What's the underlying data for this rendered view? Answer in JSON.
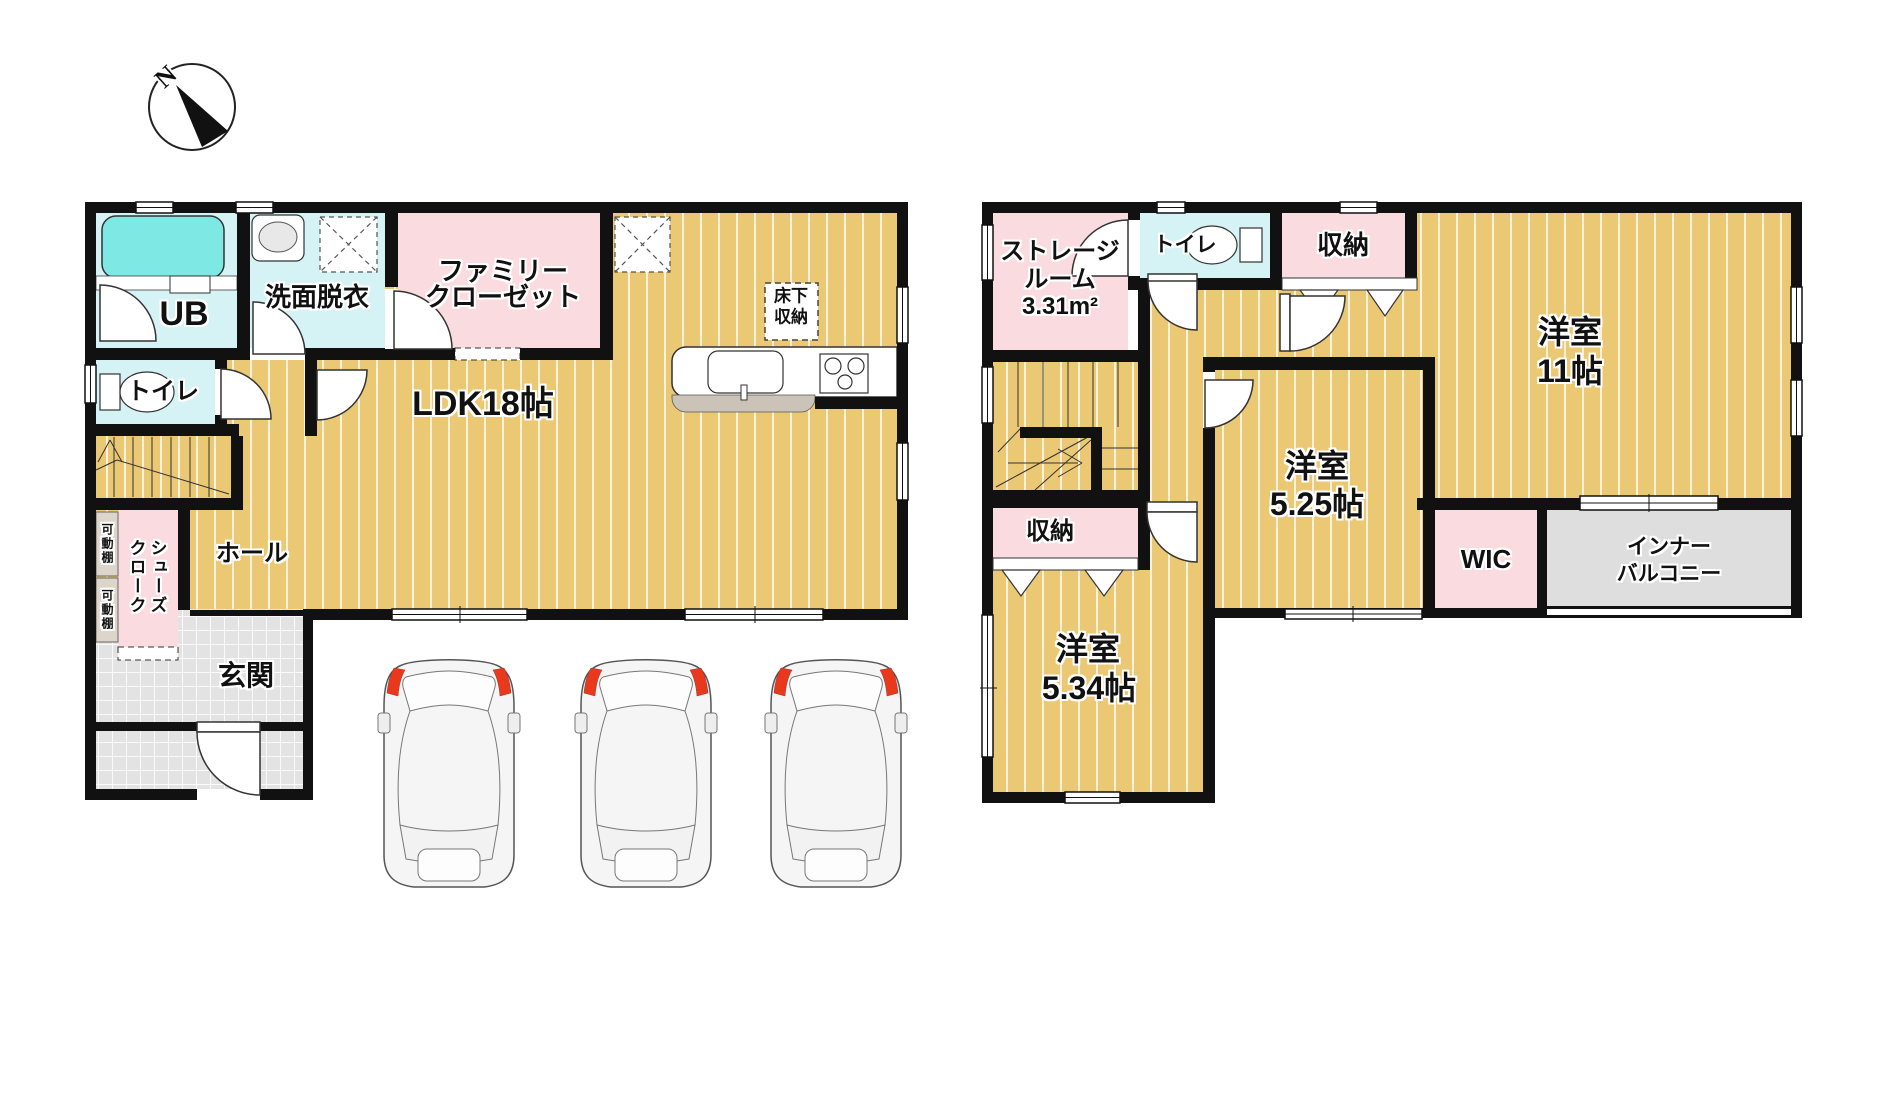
{
  "compass": {
    "north": "N"
  },
  "floor1": {
    "ub": "UB",
    "washroom": "洗面脱衣",
    "family_closet_line1": "ファミリー",
    "family_closet_line2": "クローゼット",
    "toilet": "トイレ",
    "ldk": "LDK18帖",
    "underfloor_line1": "床下",
    "underfloor_line2": "収納",
    "hall": "ホール",
    "shoes_cloak_line1": "シューズ",
    "shoes_cloak_line2": "クローク",
    "movable_shelf_1": "可動棚",
    "movable_shelf_2": "可動棚",
    "entrance": "玄関"
  },
  "floor2": {
    "storage_line1": "ストレージ",
    "storage_line2": "ルーム",
    "storage_line3": "3.31m²",
    "toilet": "トイレ",
    "closet_top": "収納",
    "room11_line1": "洋室",
    "room11_line2": "11帖",
    "room525_line1": "洋室",
    "room525_line2": "5.25帖",
    "wic": "WIC",
    "inner_balcony_line1": "インナー",
    "inner_balcony_line2": "バルコニー",
    "closet_lower": "収納",
    "room534_line1": "洋室",
    "room534_line2": "5.34帖"
  },
  "colors": {
    "floor_wood": "#ebc873",
    "room_pink": "#fadbdf",
    "room_cyan": "#d5f2f4",
    "bathtub_cyan": "#7ee9e4",
    "entrance_tile": "#e3e3e3",
    "balcony_gray": "#dedede",
    "wall_black": "#111111",
    "car_taillight": "#e8391d"
  },
  "parking": {
    "car_count": 3
  }
}
